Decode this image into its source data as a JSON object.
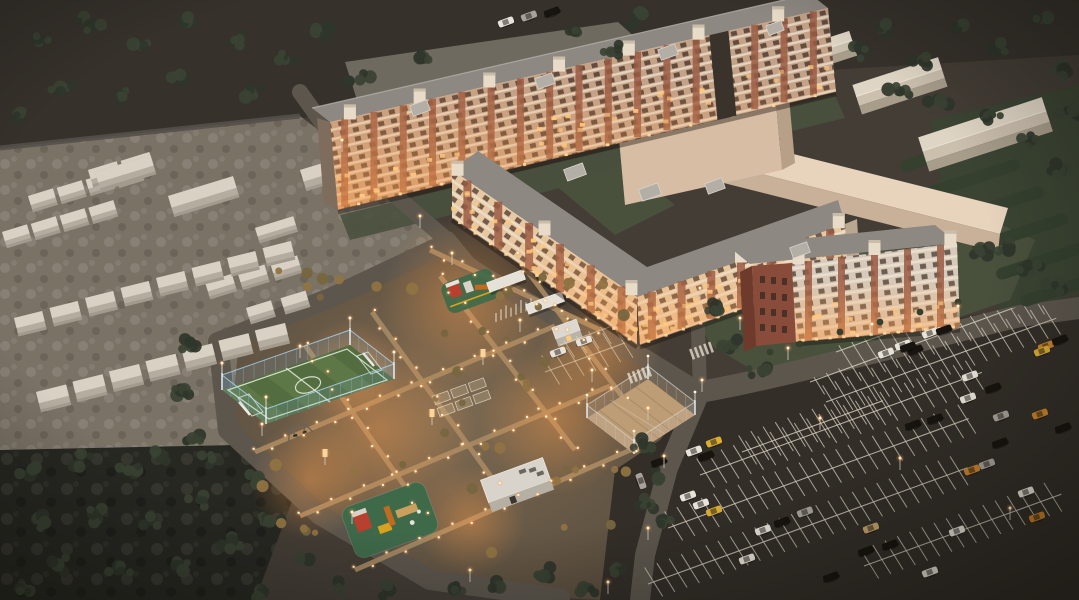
{
  "scene": {
    "setting": "aerial-dusk-render-residential-complex",
    "regions": [
      {
        "id": "north-apartment-block",
        "label": "nine-storey apartment block"
      },
      {
        "id": "central-apartment-block",
        "label": "five-storey angled apartment block"
      },
      {
        "id": "east-apartment-block",
        "label": "four-storey apartment block"
      },
      {
        "id": "windowless-shell-building",
        "label": "blank building shell"
      },
      {
        "id": "perimeter-wall-building",
        "label": "L-shaped boundary wall"
      },
      {
        "id": "warehouse-buildings",
        "label": "gable roof warehouses"
      },
      {
        "id": "west-houses-district",
        "label": "low-rise houses and garages"
      },
      {
        "id": "football-pitch",
        "label": "fenced football pitch"
      },
      {
        "id": "sand-court",
        "label": "fenced sand sports court"
      },
      {
        "id": "playground-north",
        "label": "playground"
      },
      {
        "id": "playground-south",
        "label": "playground"
      },
      {
        "id": "utility-building",
        "label": "utility building"
      },
      {
        "id": "parking-lot",
        "label": "surface parking lot"
      },
      {
        "id": "southwest-woods",
        "label": "tree park"
      },
      {
        "id": "courtyard",
        "label": "lit courtyard walkways"
      }
    ]
  },
  "palette": {
    "groundBase": "#433d35",
    "groundTop": "#36312b",
    "groundHouses": "#7a7265",
    "woods": "#272822",
    "backyard": "#6f6a60",
    "parking": "#332e28",
    "road": "#5c564d",
    "pathLit": "#a78a64",
    "lawn": "#49513d",
    "hedge": "#35402f",
    "facadeNorth": "#c3a288",
    "facadeCenter": "#e6c8a2",
    "facadeEast": "#d5cabb",
    "brick": "#9a5a43",
    "brickDark": "#8a4c3a",
    "brickEdge": "#6e3a2c",
    "trim": "#e8dcc8",
    "floorLine": "#eee2d0",
    "windowDark": "#4a372c",
    "windowLit": "#ffc87d",
    "roof": "#8d8881",
    "roofLight": "#b3aea6",
    "endWall": "#7e6c5c",
    "blankFront": "#d6bda4",
    "blankTop": "#e8d4bd",
    "blankSide": "#b89f87",
    "wallFront": "#c9b098",
    "houseLight": "#d8d1c4",
    "houseShade": "#b4ac9f",
    "houseFront": "#a19a8d",
    "warehouseRoof": "#dfd5c5",
    "warehouseRoofLow": "#cbbfae",
    "warehouseFront": "#a89d8b",
    "pitchGreen": "#5d7747",
    "pitchGreenAlt": "#536d40",
    "pitchLine": "#e9f0e2",
    "fenceBlue": "#8fc3e4",
    "sand": "#bd9d76",
    "fenceGrey": "#cdc8bd",
    "playPad": "#3f6a4a",
    "playRed": "#b8402e",
    "playYellow": "#d9a21e",
    "playOrange": "#c06a22",
    "playDeck": "#caa05c",
    "treeDark": "#2f352a",
    "treeMid": "#3a4233",
    "shrubWarm": "#77663f",
    "shrubLit": "#8f7342",
    "lightCore": "#fff3d8",
    "lightGlow": "#ffae55",
    "glowWarm": "#ff9e4a",
    "carWhite": "#e8e3d8",
    "carBlack": "#17140f",
    "carSilver": "#a8a29a",
    "carOrange": "#c8832b",
    "carYellow": "#d9ad33",
    "carTan": "#c2a36a",
    "parkLine": "#d9d2c2",
    "white": "#f2efe8",
    "pole": "#cfc8bc"
  }
}
